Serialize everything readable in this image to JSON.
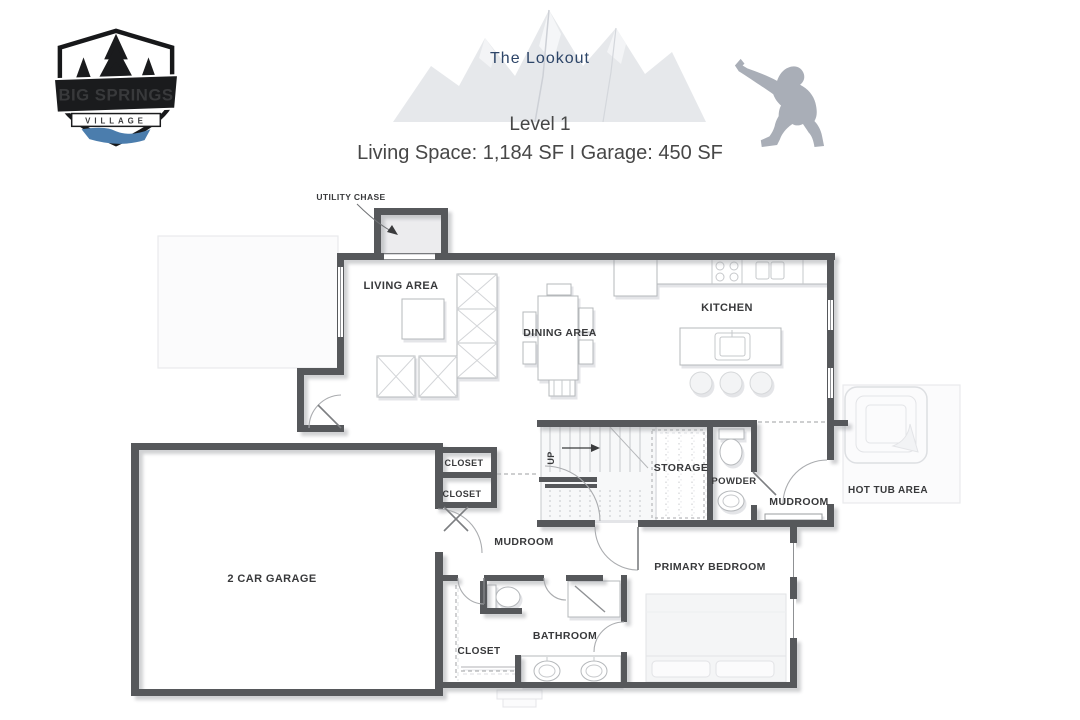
{
  "header": {
    "logo": {
      "top": "BIG SPRINGS",
      "bottom": "VILLAGE"
    },
    "title": "The Lookout",
    "level": "Level 1",
    "stats": "Living Space: 1,184 SF I Garage: 450 SF"
  },
  "colors": {
    "title_navy": "#2d4568",
    "subtitle_gray": "#474747",
    "wall_gray": "#56585b",
    "label_gray": "#38393b",
    "sasquatch_gray": "#a9aeb7",
    "logo_river_blue": "#4b7dad",
    "mountain_gray": "#e2e4e8"
  },
  "floorplan": {
    "labels": {
      "utility_chase": "UTILITY CHASE",
      "living_area": "LIVING AREA",
      "dining_area": "DINING AREA",
      "kitchen": "KITCHEN",
      "closet_upper": "CLOSET",
      "closet_lower": "CLOSET",
      "stairs_up": "UP",
      "storage": "STORAGE",
      "powder": "POWDER",
      "mudroom_east": "MUDROOM",
      "hot_tub_area": "HOT TUB AREA",
      "garage": "2 CAR GARAGE",
      "mudroom_center": "MUDROOM",
      "primary_bedroom": "PRIMARY BEDROOM",
      "bathroom": "BATHROOM",
      "closet_bedroom": "CLOSET"
    }
  }
}
